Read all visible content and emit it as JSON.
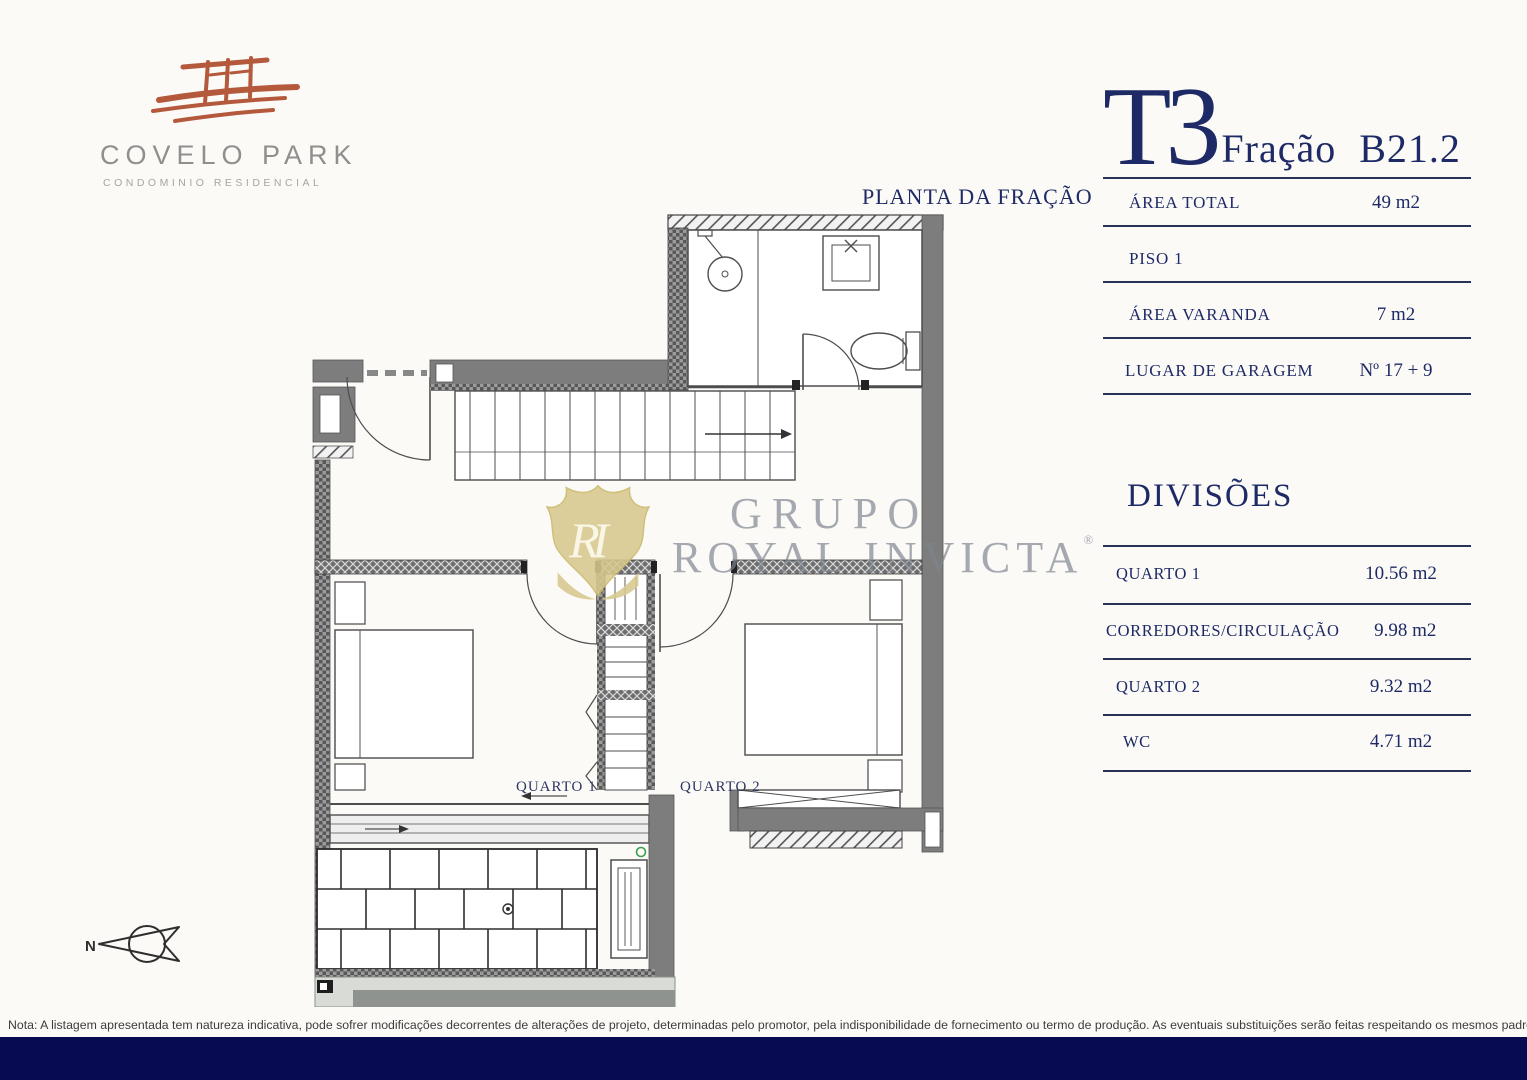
{
  "page": {
    "background": "#fbfaf7",
    "accent_navy": "#1e2a66",
    "bar_navy": "#070c52",
    "terracotta": "#b4593c",
    "watermark_gold": "#d8c98e",
    "wall_gray": "#7d7d7d"
  },
  "logo": {
    "name": "COVELO PARK",
    "subtitle": "CONDOMINIO RESIDENCIAL"
  },
  "header": {
    "typology": "T3",
    "fraction_label": "Fração",
    "fraction_code": "B21.2"
  },
  "summary_rows": [
    {
      "label": "ÁREA TOTAL",
      "value": "49 m2"
    },
    {
      "label": "PISO 1",
      "value": ""
    },
    {
      "label": "ÁREA VARANDA",
      "value": "7 m2"
    },
    {
      "label": "LUGAR DE GARAGEM",
      "value": "Nº 17 + 9"
    }
  ],
  "divisions": {
    "title": "DIVISÕES",
    "rows": [
      {
        "label": "QUARTO 1",
        "value": "10.56 m2"
      },
      {
        "label": "CORREDORES/CIRCULAÇÃO",
        "value": "9.98 m2"
      },
      {
        "label": "QUARTO 2",
        "value": "9.32 m2"
      },
      {
        "label": "WC",
        "value": "4.71 m2"
      }
    ]
  },
  "plan": {
    "title": "PLANTA DA FRAÇÃO",
    "room_labels": [
      "QUARTO 1",
      "QUARTO 2"
    ],
    "compass_label": "N"
  },
  "watermark": {
    "monogram": "RI",
    "line1": "GRUPO",
    "line2": "ROYAL INVICTA",
    "registered": "®"
  },
  "footer": {
    "note": "Nota: A listagem apresentada tem natureza indicativa, pode sofrer modificações decorrentes de alterações de projeto, determinadas pelo promotor, pela indisponibilidade de fornecimento ou termo de produção. As eventuais substituições serão feitas respeitando os mesmos padrões de qualidade."
  }
}
